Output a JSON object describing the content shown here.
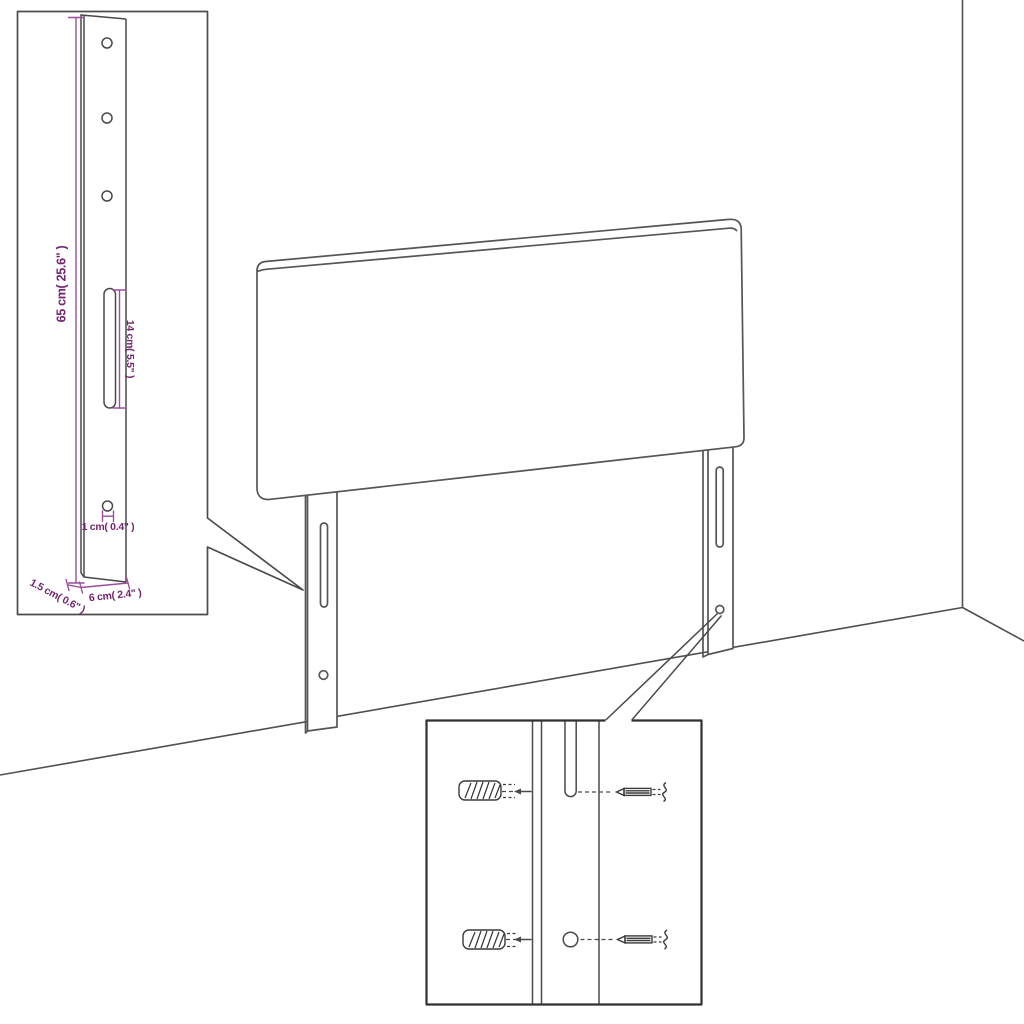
{
  "diagram": {
    "type": "furniture-assembly-instruction",
    "subject": "Headboard with two mounting legs shown in room corner, with leg dimension inset and wall-mounting hardware inset",
    "colors": {
      "background": "#ffffff",
      "outline": "#565656",
      "detail_inset_border": "#4c4c4c",
      "mounting_inset_border": "#303030",
      "dimension_line": "#9b4f9c",
      "dimension_text": "#73256f"
    },
    "leg_detail": {
      "dimensions": {
        "height": "65 cm( 25.6\" )",
        "slot_length": "14 cm( 5.5\" )",
        "hole": "1 cm( 0.4\" )",
        "thickness": "1.5 cm( 0.6\" )",
        "width": "6 cm( 2.4\" )"
      },
      "top_hole_count": 3,
      "bottom_hole_count": 1,
      "slot_count": 1
    },
    "headboard": {
      "leg_count": 2,
      "slots_per_leg": 1,
      "holes_per_leg": 1
    },
    "mounting_detail": {
      "hardware": [
        "wall plug",
        "screw"
      ],
      "alignment_targets": [
        "leg slot",
        "leg hole"
      ]
    }
  }
}
